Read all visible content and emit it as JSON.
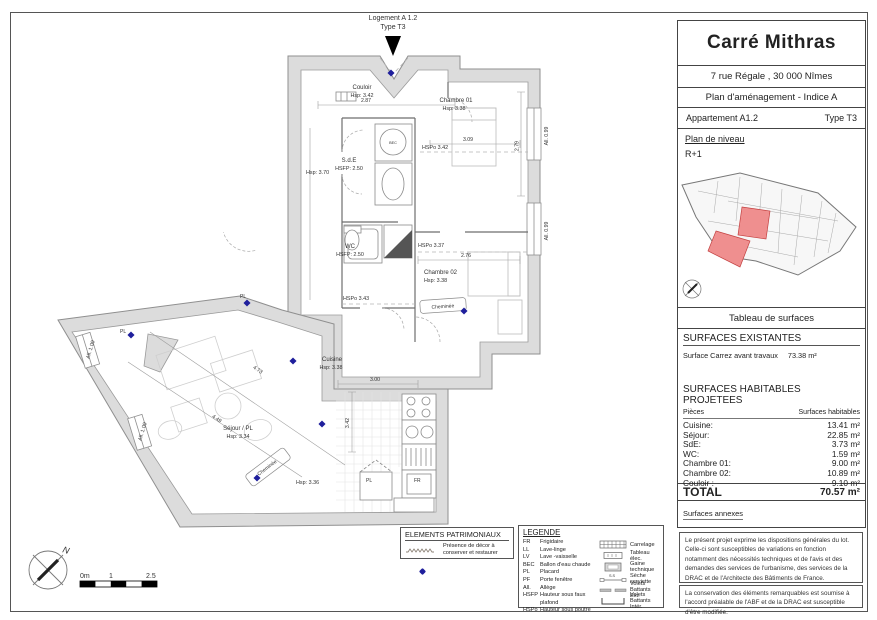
{
  "title_block": {
    "project_title": "Carré Mithras",
    "address": "7 rue Régale , 30 000 Nîmes",
    "document_title": "Plan d'aménagement - Indice  A",
    "apartment": "Appartement A1.2",
    "apartment_type": "Type T3",
    "level_label": "Plan de niveau",
    "level": "R+1",
    "highlight_color": "#ef8f8f"
  },
  "surfaces": {
    "table_title": "Tableau de surfaces",
    "existing_title": "SURFACES EXISTANTES",
    "existing_label": "Surface Carrez avant travaux",
    "existing_value": "73.38 m²",
    "projected_title": "SURFACES HABITABLES PROJETEES",
    "col_room": "Pièces",
    "col_area": "Surfaces habitables",
    "rows": [
      {
        "label": "Cuisine:",
        "value": "13.41 m²"
      },
      {
        "label": "Séjour:",
        "value": "22.85 m²"
      },
      {
        "label": "SdE:",
        "value": "3.73 m²"
      },
      {
        "label": "WC:",
        "value": "1.59 m²"
      },
      {
        "label": "Chambre 01:",
        "value": "9.00 m²"
      },
      {
        "label": "Chambre 02:",
        "value": "10.89 m²"
      },
      {
        "label": "Couloir :",
        "value": "9.10 m²"
      }
    ],
    "total_label": "TOTAL",
    "total_value": "70.57 m²",
    "annex_label": "Surfaces annexes"
  },
  "notes": {
    "note1": "Le présent projet exprime les dispositions générales du lot. Celle-ci sont susceptibles de variations en fonction notamment des nécessités techniques et de l'avis et des demandes des services de l'urbanisme, des services de la DRAC et de l'Architecte des Bâtiments de France.",
    "note2": "La conservation des éléments remarquables est soumise à l'accord préalable de l'ABF et de la DRAC est susceptible d'être modifiée."
  },
  "patrimonial": {
    "title": "ELEMENTS PATRIMONIAUX",
    "item": "Présence de décor à conserver et restaurer"
  },
  "legend": {
    "title": "LEGENDE",
    "abbreviations": [
      {
        "code": "FR",
        "label": "Frigidaire"
      },
      {
        "code": "LL",
        "label": "Lave-linge"
      },
      {
        "code": "LV",
        "label": "Lave -vaisselle"
      },
      {
        "code": "BEC",
        "label": "Ballon d'eau chaude"
      },
      {
        "code": "PL",
        "label": "Placard"
      },
      {
        "code": "PF",
        "label": "Porte fenêtre"
      },
      {
        "code": "All.",
        "label": "Allège"
      },
      {
        "code": "HSFP",
        "label": "Hauteur sous faux plafond"
      },
      {
        "code": "HSPo",
        "label": "Hauteur sous poutre"
      }
    ],
    "symbols": [
      {
        "label": "Carrelage"
      },
      {
        "label": "Tableau élec."
      },
      {
        "label": "Gaine technique"
      },
      {
        "label": "Sèche serviette",
        "tag": "S.S"
      },
      {
        "label": "Volets Battants Ext."
      },
      {
        "label": "Volets Battants Intér."
      }
    ]
  },
  "plan": {
    "header": {
      "line1": "Logement A 1.2",
      "line2": "Type T3"
    },
    "rooms": {
      "couloir": {
        "name": "Couloir",
        "h": "Hsp: 3.42"
      },
      "chambre01": {
        "name": "Chambre 01",
        "h": "Hsp: 3.38"
      },
      "sde": {
        "name": "S.d.E",
        "h": "HSFP: 2.50"
      },
      "wc": {
        "name": "WC",
        "h": "HSFP: 2.50"
      },
      "chambre02": {
        "name": "Chambre 02",
        "h": "Hsp: 3.38"
      },
      "cuisine": {
        "name": "Cuisine",
        "h": "Hsp: 3.38"
      },
      "sejour": {
        "name": "Séjour / PL",
        "h": "Hsp: 3.34"
      }
    },
    "annotations": {
      "hsp370": "Hsp: 3.70",
      "hspo342": "HSPo 3.42",
      "hspo337": "HSPo 3.37",
      "hspo343": "HSPo 3.43",
      "hsp336": "Hsp: 3.36",
      "cheminee": "Cheminée",
      "pl": "PL",
      "fr": "FR",
      "bec": "BEC"
    },
    "dims": {
      "d1": "2.87",
      "d2": "3.09",
      "d3": "2.79",
      "d4": "2.76",
      "d5": "3.00",
      "d6": "3.42",
      "d7": "4.73",
      "d8": "4.49",
      "all099": "All. 0.99",
      "all100": "All. 1.00"
    },
    "scale_bar": {
      "s0": "0m",
      "s1": "1",
      "s2": "2.5"
    },
    "north": "N"
  }
}
